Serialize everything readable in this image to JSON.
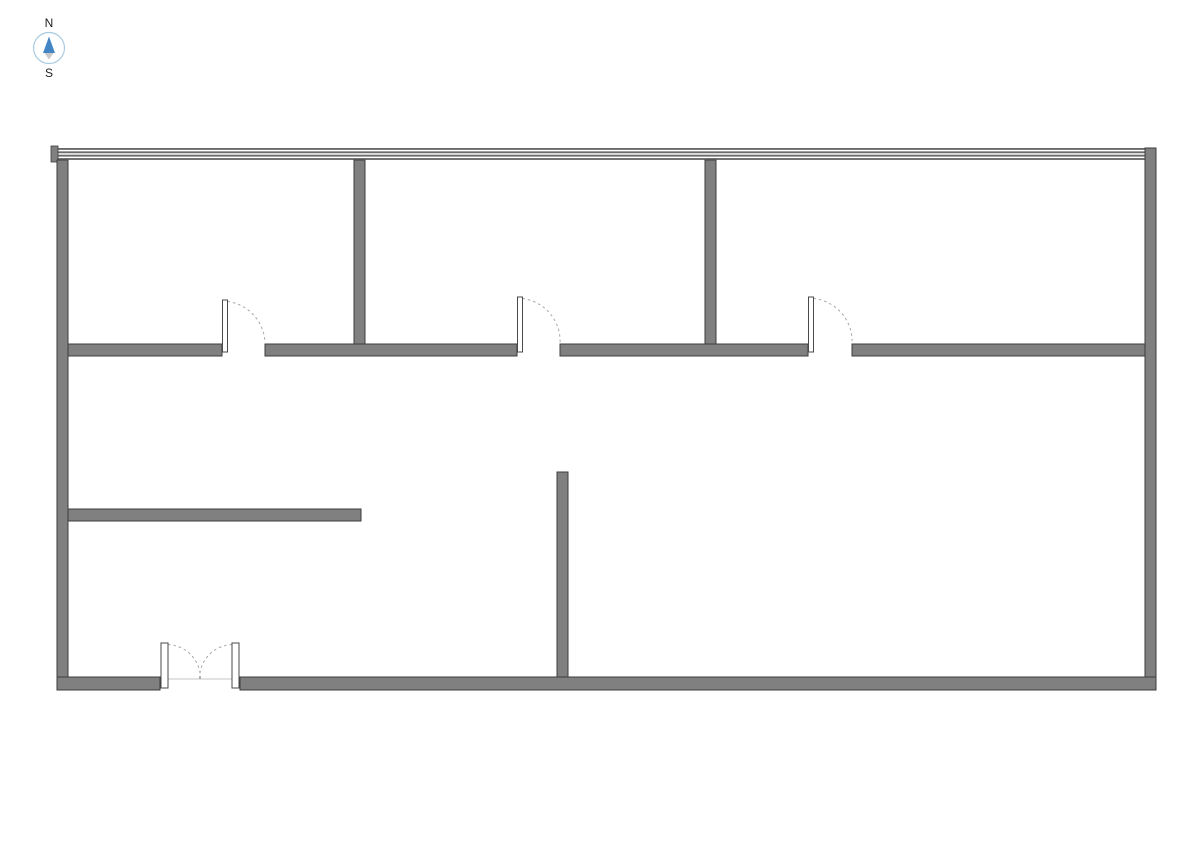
{
  "compass": {
    "north_label": "N",
    "south_label": "S",
    "colors": {
      "ring": "#a9cbe1",
      "needle_north": "#4285c4",
      "needle_south": "#c9c9c9",
      "text": "#1f1f1f"
    }
  },
  "floorplan": {
    "colors": {
      "background": "#ffffff",
      "wall_fill": "#808080",
      "wall_outline": "#3d3d3d",
      "window_line": "#6b6b6b",
      "door_leaf_fill": "#ffffff",
      "door_leaf_outline": "#4a4a4a",
      "swing_arc": "#a6a6a6",
      "threshold": "#c4c4c4"
    },
    "window_wall": {
      "x": 57,
      "y": 148,
      "length": 1088,
      "line_count": 4,
      "line_thickness": 1.9,
      "line_gap": 1.45,
      "end_cap": {
        "x": 51,
        "y": 146,
        "w": 7,
        "h": 16
      }
    },
    "walls": [
      {
        "name": "exterior-left",
        "x": 57,
        "y": 160,
        "w": 11,
        "h": 530
      },
      {
        "name": "exterior-right",
        "x": 1145,
        "y": 148,
        "w": 11,
        "h": 542
      },
      {
        "name": "exterior-bottom-west",
        "x": 57,
        "y": 677,
        "w": 103,
        "h": 13
      },
      {
        "name": "exterior-bottom-east",
        "x": 240,
        "y": 677,
        "w": 916,
        "h": 13
      },
      {
        "name": "corridor-segment-1",
        "x": 68,
        "y": 344,
        "w": 154,
        "h": 12
      },
      {
        "name": "corridor-segment-2",
        "x": 265,
        "y": 344,
        "w": 252,
        "h": 12
      },
      {
        "name": "corridor-segment-3",
        "x": 560,
        "y": 344,
        "w": 248,
        "h": 12
      },
      {
        "name": "corridor-segment-4",
        "x": 852,
        "y": 344,
        "w": 293,
        "h": 12
      },
      {
        "name": "partition-room1-room2",
        "x": 354,
        "y": 160,
        "w": 11,
        "h": 184
      },
      {
        "name": "partition-room2-room3",
        "x": 705,
        "y": 160,
        "w": 11,
        "h": 184
      },
      {
        "name": "lower-partition-horizontal",
        "x": 68,
        "y": 509,
        "w": 293,
        "h": 12
      },
      {
        "name": "lower-partition-vertical",
        "x": 557,
        "y": 472,
        "w": 11,
        "h": 205
      }
    ],
    "single_doors": [
      {
        "name": "door-room1",
        "opening_x1": 222,
        "opening_x2": 265,
        "wall_top_y": 344,
        "leaf_top_y": 300
      },
      {
        "name": "door-room2",
        "opening_x1": 517,
        "opening_x2": 560,
        "wall_top_y": 344,
        "leaf_top_y": 297
      },
      {
        "name": "door-room3",
        "opening_x1": 808,
        "opening_x2": 852,
        "wall_top_y": 344,
        "leaf_top_y": 297
      }
    ],
    "double_door": {
      "name": "entrance-double-door",
      "opening_x1": 160,
      "opening_x2": 240,
      "wall_top_y": 677,
      "leaf_top_y": 643,
      "leaf_w": 7,
      "leaf_h": 45
    }
  }
}
